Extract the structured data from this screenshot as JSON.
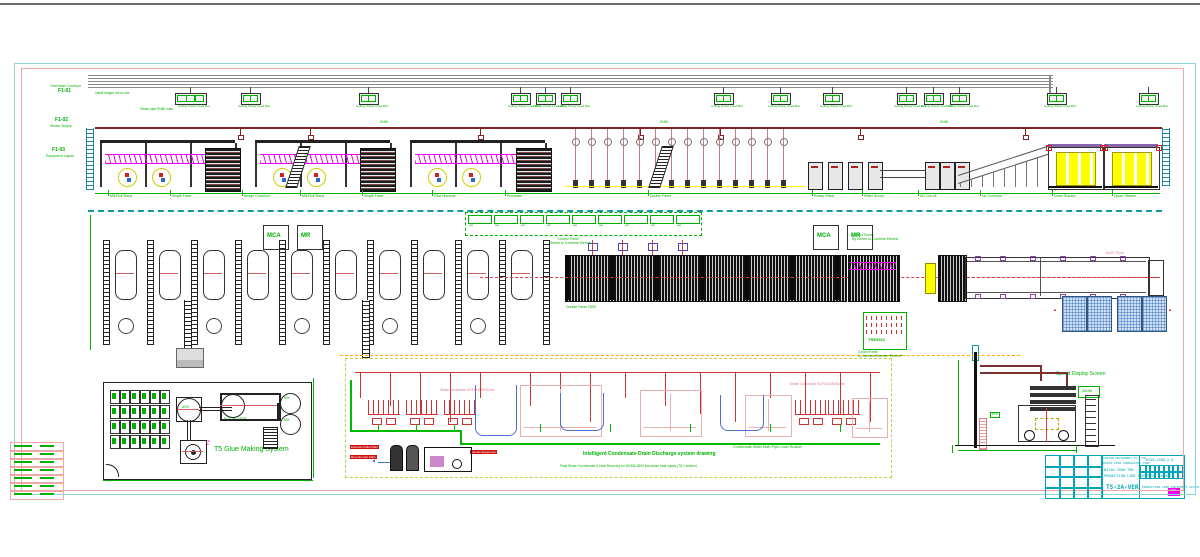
{
  "drawing": {
    "kind": "corrugated production line layout CAD drawing",
    "accent_colors": {
      "frame_cyan": "#8fd6d6",
      "frame_pink": "#efa8a8",
      "cad_green": "#00b000",
      "pipe_maroon": "#7b2424",
      "magenta": "#ee00ee",
      "yellow": "#ffff00",
      "teal": "#0f9b9b",
      "red": "#cc2222",
      "blue": "#4d6fd0",
      "title_cyan": "#00a6b8"
    }
  },
  "left_labels": [
    {
      "code": "F1-01",
      "label": "Overhead Conveyor"
    },
    {
      "code": "F1-02",
      "label": "Steam Supply"
    },
    {
      "code": "F1-03",
      "label": "Equipment Layout"
    }
  ],
  "elevation": {
    "hanger_note": "Ceiling Power Feed Box",
    "machine_labels": [
      {
        "x": 108,
        "text": "Mill Roll Stand"
      },
      {
        "x": 170,
        "text": "Single Facer"
      },
      {
        "x": 242,
        "text": "Bridge Conveyor"
      },
      {
        "x": 300,
        "text": "Mill Roll Stand"
      },
      {
        "x": 362,
        "text": "Single Facer"
      },
      {
        "x": 432,
        "text": "Glue Machine"
      },
      {
        "x": 505,
        "text": "Preheater"
      },
      {
        "x": 648,
        "text": "Double Facer"
      },
      {
        "x": 812,
        "text": "Rotary Shear"
      },
      {
        "x": 862,
        "text": "Slitter Scorer"
      },
      {
        "x": 918,
        "text": "NC Cut-off"
      },
      {
        "x": 980,
        "text": "Up Conveyor"
      },
      {
        "x": 1052,
        "text": "Down Stacker"
      },
      {
        "x": 1112,
        "text": "Upper Stacker"
      }
    ],
    "note1": "Install hanger rail on site",
    "note2": "Steam pipe DN80 main"
  },
  "plan": {
    "cells_note1": "Control Panel",
    "cells_note2": "By Series to Combine Electric",
    "box1": "MCA",
    "box2": "MR",
    "panel_code": "TRE0912",
    "panel_note1": "Control Panel",
    "panel_note2": "By Series to Combine Electric",
    "room_note1": "Control Room",
    "room_note2": "By Series to Combine Electric",
    "speed_note": "1400 T/pm",
    "facer_note": "Double Facer 2500"
  },
  "glue": {
    "title": "T5 Glue Making System",
    "mixer_label": "EQUALIZER",
    "agitator_label": "AGR",
    "tank1_label": "MIX",
    "tank2_label": "MIX",
    "pump_label": "P-1"
  },
  "steam": {
    "title": "Intelligent Condensate Drain Discharge system drawing",
    "note": "Float Steam Condensate & Heat Recovery for WJ250-2500 line steam heat supply (T5.1 section)",
    "bracket_label": "Condensate Water Main Pipe Lower Bracket",
    "header_label_1": "Steam Connection SGP25 (DN25) line",
    "header_label_2": "Steam Connection SGP25 (DN25) line",
    "tag1": "Exhaust Outlet Main",
    "tag2": "Recycle Inlet Main",
    "tag3": "Electric Equipment"
  },
  "stacker_side": {
    "screen_label": "Speed Display Screen",
    "display_text": "450M",
    "chip_label": "B18"
  },
  "titleblock": {
    "company": "CARTON MACHINERY CO.,LTD",
    "project": "WJ250-2500 CORRUGATED LINE",
    "drawing_no": "WJ250-2500-T5B",
    "sheet_no": "R250-2500-2-H",
    "version": "T5-2A-VER",
    "desc": "PRODUCTION LINE EQUIPMENT LAYOUT",
    "logo": "LOGO"
  },
  "geometry": {
    "frame": {
      "top_line_y": 3,
      "cyan": [
        14,
        63,
        1180,
        430
      ],
      "pink": [
        21,
        68,
        1161,
        421
      ]
    },
    "rails": {
      "x1": 88,
      "x2": 1053,
      "y": 75,
      "count": 5,
      "gap": 3
    },
    "hangers": [
      190,
      250,
      368,
      520,
      545,
      570,
      723,
      780,
      832,
      906,
      933,
      959,
      1056,
      1148
    ],
    "steam_pipe_y": 127,
    "drops": {
      "x1": 575,
      "n": 14,
      "step": 16,
      "y2": 185,
      "circle_y": 138
    },
    "stubs": [
      240,
      310,
      480,
      640,
      720,
      860,
      1025
    ],
    "bays": [
      100,
      255,
      410
    ],
    "bay_w": 135,
    "clutter": [
      [
        205,
        148
      ],
      [
        360,
        148
      ],
      [
        516,
        148
      ]
    ],
    "ladders": [
      292,
      655
    ],
    "right_machines": [
      808,
      828,
      848,
      868,
      925,
      940,
      955
    ],
    "stackers": [
      1048,
      1104
    ],
    "plan_rails": {
      "x1": 103,
      "step": 44,
      "n": 11,
      "y": 240,
      "h": 105
    },
    "vstrips": [
      184,
      362
    ],
    "label_boxes": [
      [
        263,
        225
      ],
      [
        297,
        225
      ],
      [
        813,
        225
      ],
      [
        847,
        225
      ]
    ],
    "pallets": [
      [
        1062,
        296
      ],
      [
        1087,
        296
      ],
      [
        1117,
        296
      ],
      [
        1142,
        296
      ]
    ],
    "fittings": [
      592,
      622,
      652,
      682
    ],
    "steam_risers": [
      360,
      390,
      420,
      450,
      480,
      530,
      560,
      590,
      625,
      665,
      700,
      735,
      770,
      805,
      840,
      870
    ],
    "steam_combs": [
      368,
      406,
      444,
      795,
      828
    ],
    "ghosts": [
      [
        520,
        385,
        80,
        50
      ],
      [
        640,
        390,
        60,
        45
      ],
      [
        745,
        395,
        45,
        40
      ],
      [
        852,
        398,
        34,
        38
      ]
    ]
  }
}
